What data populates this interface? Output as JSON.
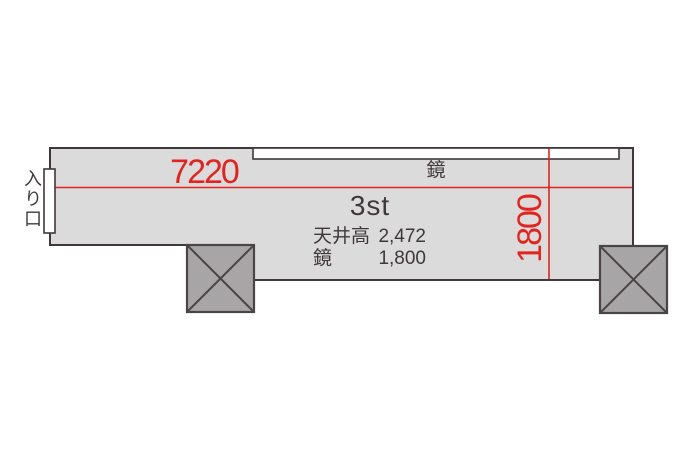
{
  "floorplan": {
    "room_label": "3st",
    "entrance_label": "入り口",
    "mirror_label": "鏡",
    "dimensions": {
      "room_width": "7220",
      "mirror_length": "1800"
    },
    "specs": [
      {
        "label": "天井高",
        "value": "2,472"
      },
      {
        "label": "鏡",
        "value": "1,800"
      }
    ],
    "colors": {
      "room_fill": "#dcdbdb",
      "pillar_fill": "#a8a5a6",
      "outline": "#3e383a",
      "dimension_red": "#e3231d",
      "text": "#3e383a",
      "background": "#ffffff"
    }
  }
}
